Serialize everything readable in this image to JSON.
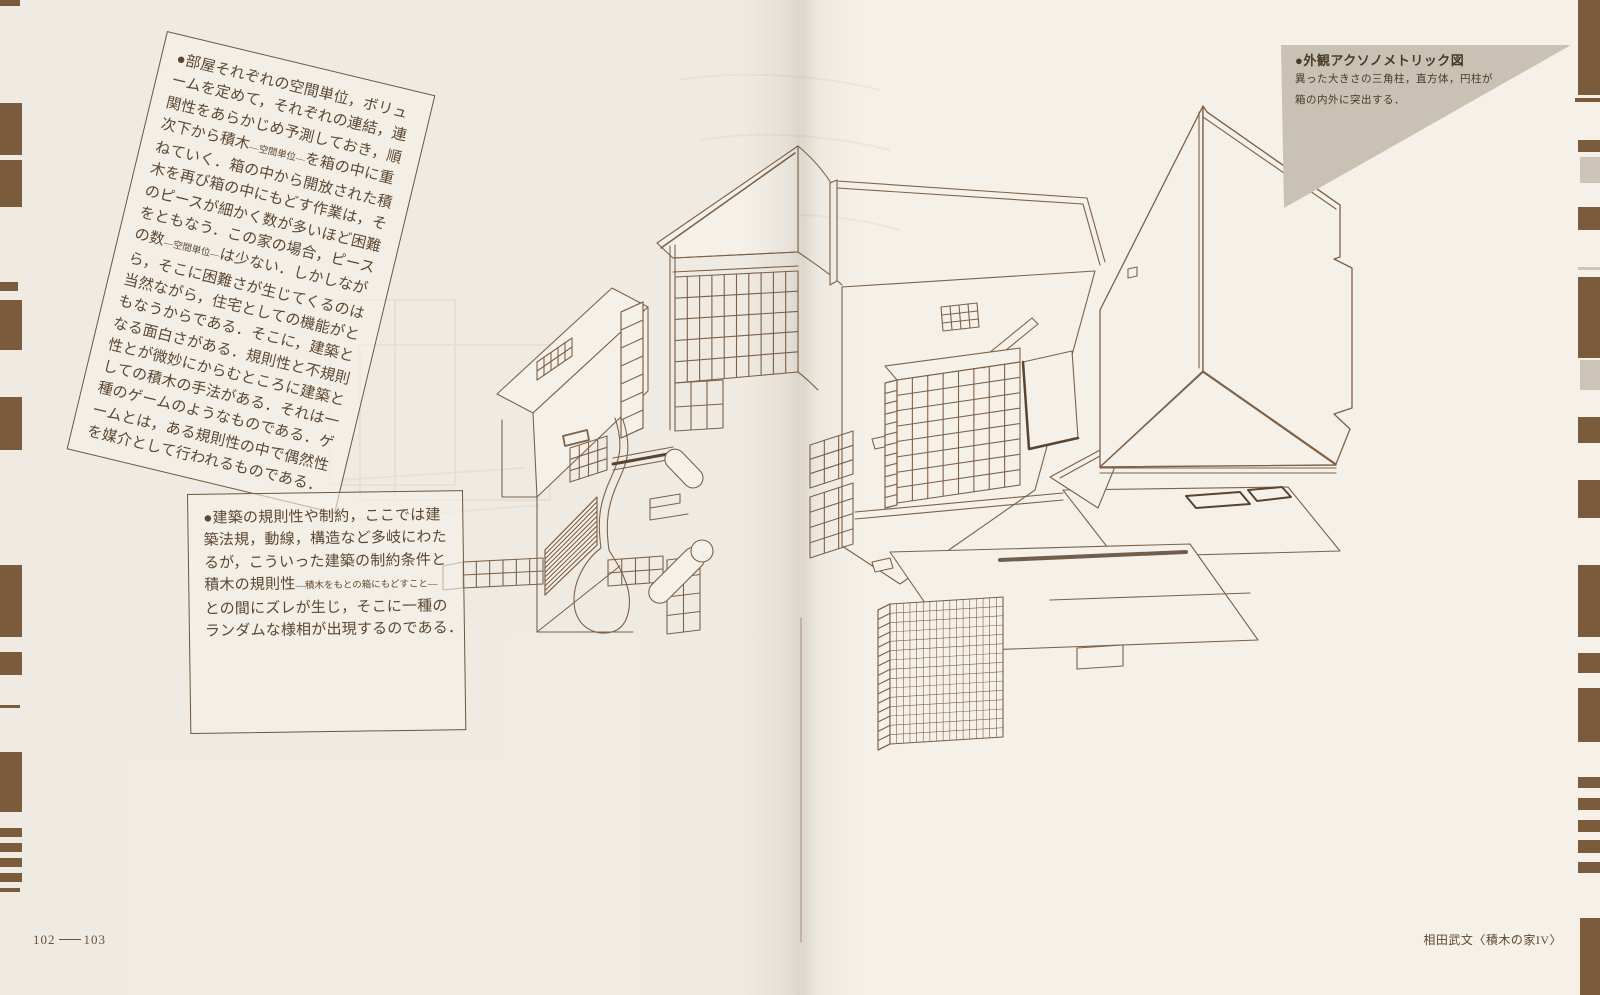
{
  "text_block_1": {
    "lines": [
      "●部屋それぞれの空間単位，ボリュ",
      "ームを定めて，それぞれの連結，連",
      "関性をあらかじめ予測しておき，順",
      "次下から積木~—空間単位—~を箱の中に重",
      "ねていく．箱の中から開放された積",
      "木を再び箱の中にもどす作業は，そ",
      "のピースが細かく数が多いほど困難",
      "をともなう．この家の場合，ピース",
      "の数~—空間単位—~は少ない．しかしなが",
      "ら，そこに困難さが生じてくるのは",
      "当然ながら，住宅としての機能がと",
      "もなうからである．そこに，建築と",
      "なる面白さがある．規則性と不規則",
      "性とが微妙にからむところに建築と",
      "しての積木の手法がある．それは一",
      "種のゲームのようなものである．ゲ",
      "ームとは，ある規則性の中で偶然性",
      "を媒介として行われるものである．"
    ]
  },
  "text_block_2": {
    "lines": [
      "●建築の規則性や制約，ここでは建",
      "築法規，動線，構造など多岐にわた",
      "るが，こういった建築の制約条件と",
      "積木の規則性~—積木をもとの箱にもどすこと—~",
      "との間にズレが生じ，そこに一種の",
      "ランダムな様相が出現するのである．"
    ]
  },
  "figure_caption": {
    "title": "●外観アクソノメトリック図",
    "lines": [
      "異った大きさの三角柱，直方体，円柱が",
      "箱の内外に突出する．"
    ]
  },
  "footer": {
    "left_page_number": "102",
    "right_page_number": "103",
    "right_caption": "相田武文〈積木の家IV〉"
  },
  "colors": {
    "paper": "#f5f1e9",
    "ink": "#7d6148",
    "ink_dark": "#54402c",
    "text": "#5d4731",
    "edge_bar": "#7a5b3c",
    "edge_bar_light": "#cdc5b7",
    "caption_triangle": "#c9c1b3"
  }
}
